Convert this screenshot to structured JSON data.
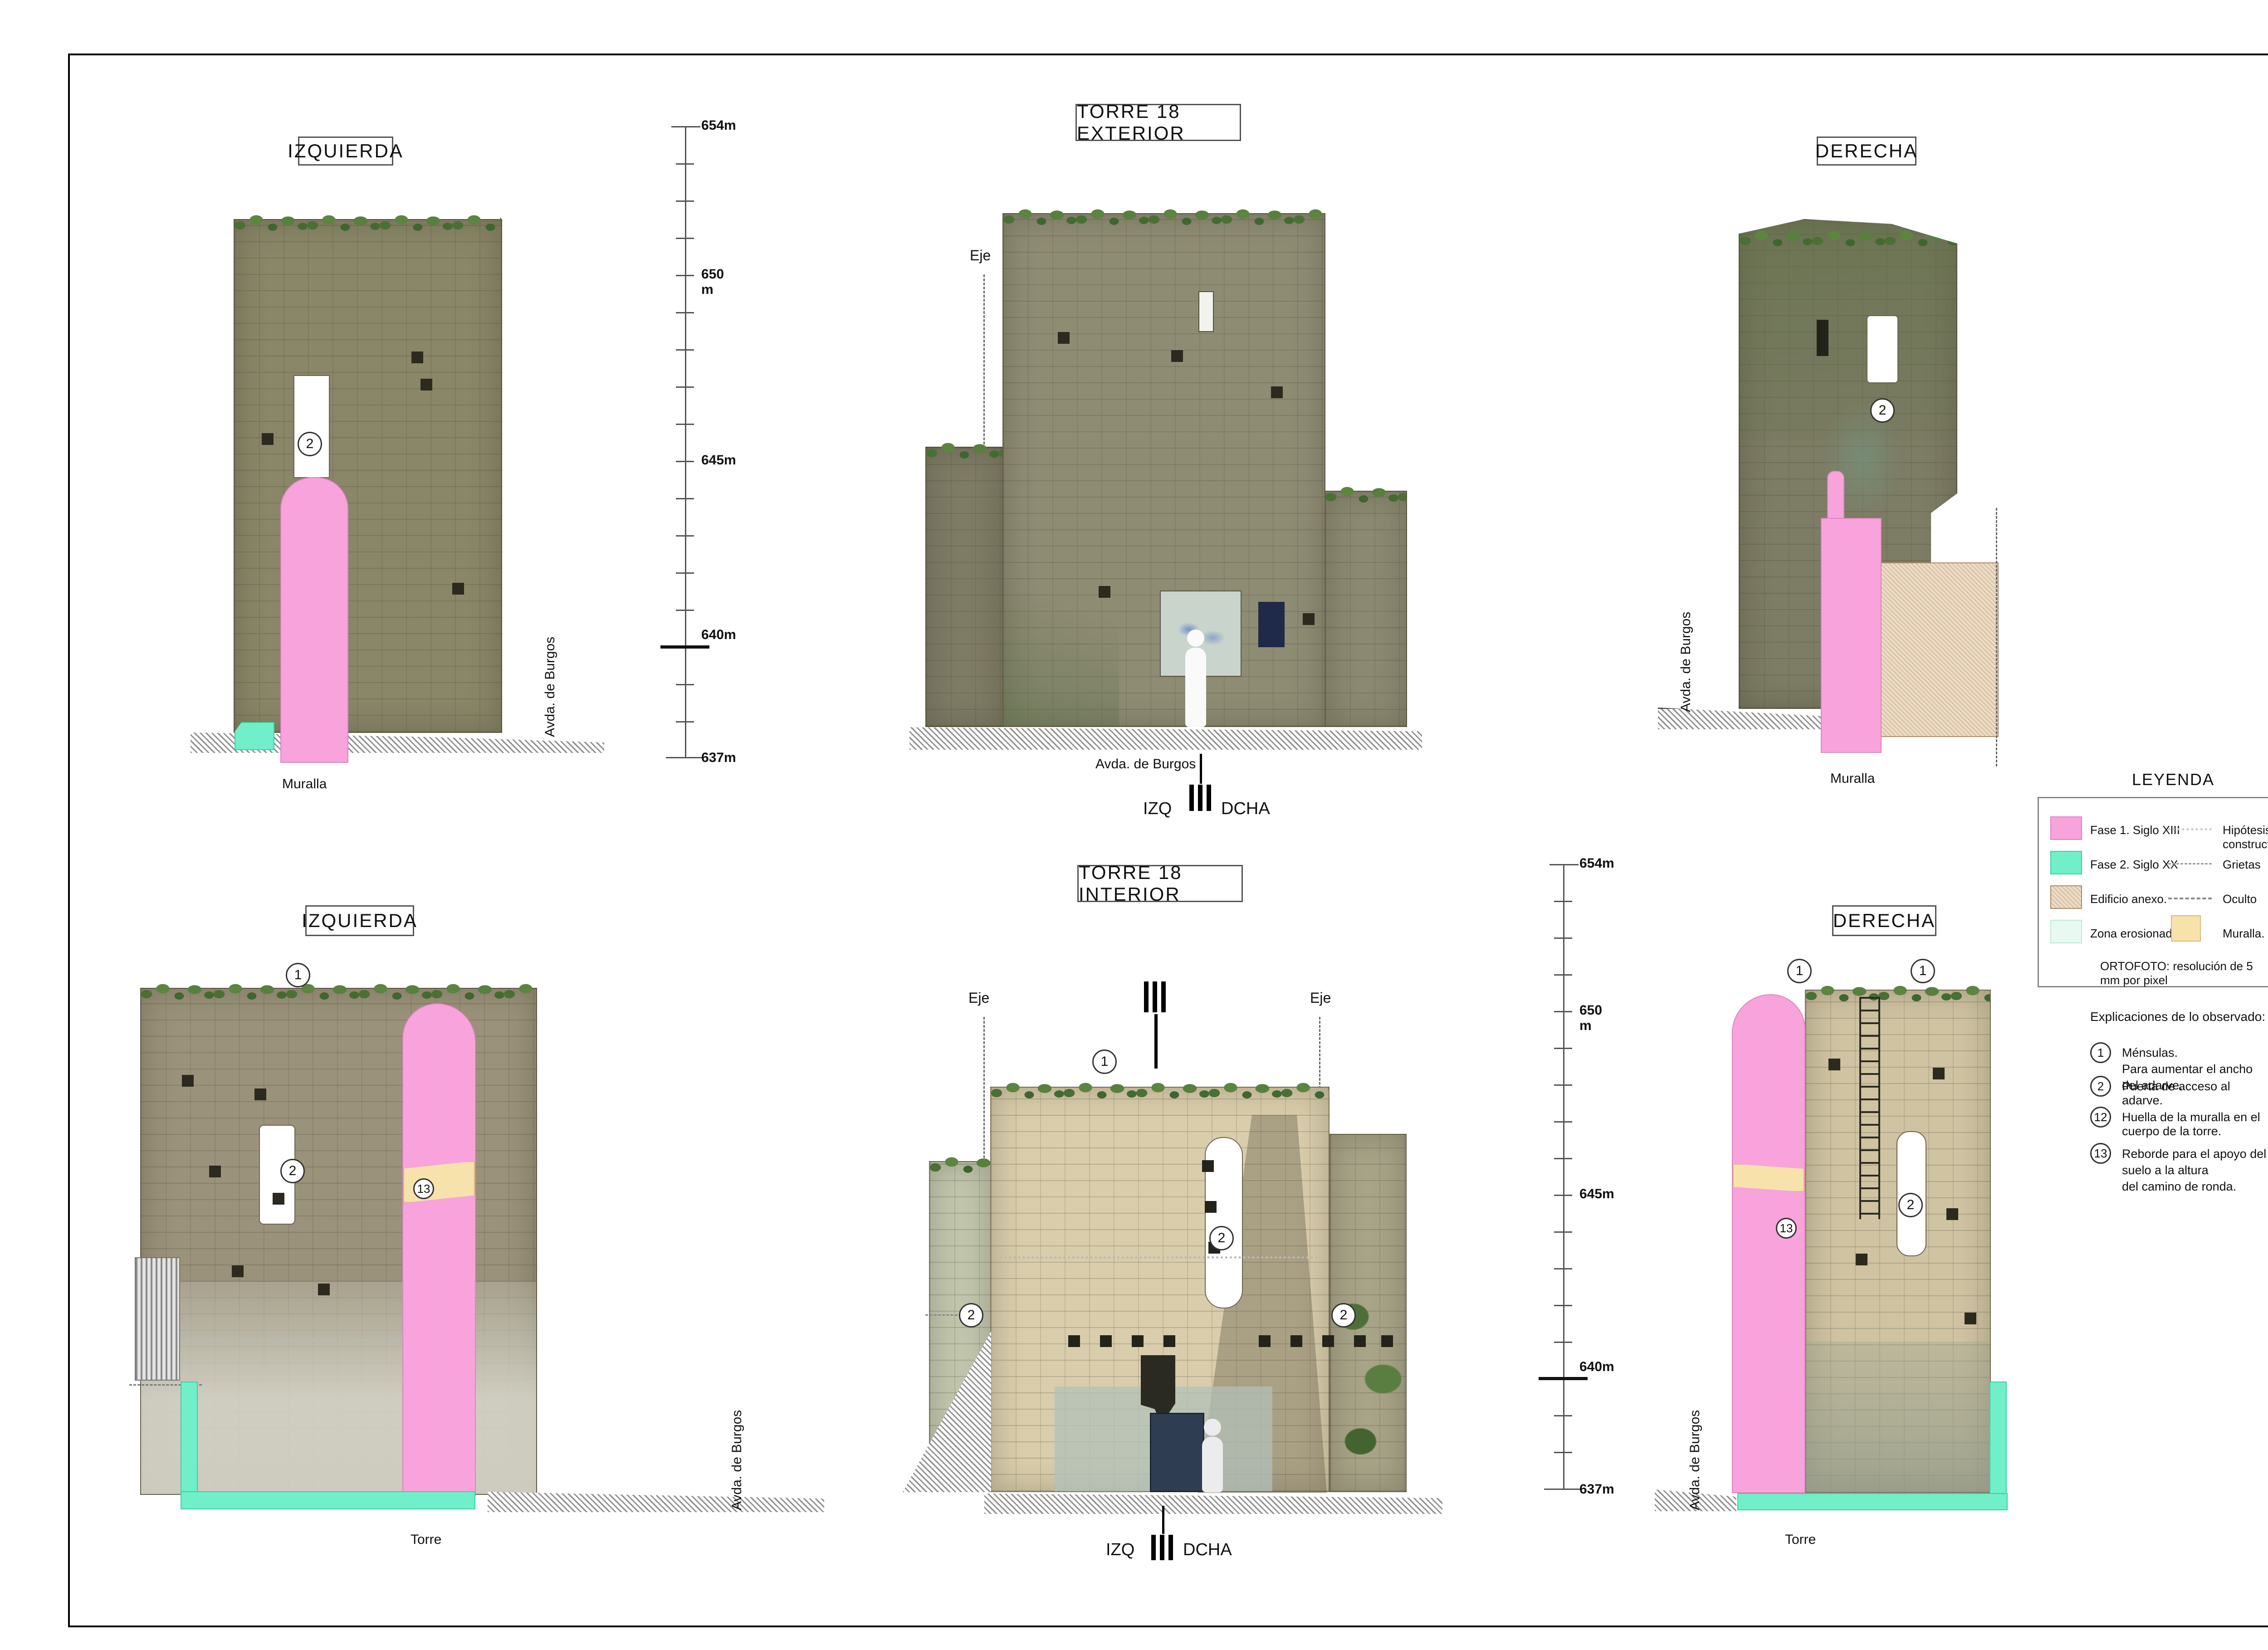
{
  "common": {
    "eje": "Eje",
    "street": "Avda. de Burgos",
    "muralla": "Muralla",
    "torre": "Torre",
    "izq": "IZQ",
    "dcha": "DCHA"
  },
  "views": {
    "top_left": {
      "title": "IZQUIERDA"
    },
    "exterior": {
      "title": "TORRE 18  EXTERIOR"
    },
    "top_right": {
      "title": "DERECHA"
    },
    "bottom_left": {
      "title": "IZQUIERDA"
    },
    "interior": {
      "title": "TORRE 18  INTERIOR"
    },
    "bottom_right": {
      "title": "DERECHA"
    }
  },
  "markers": {
    "n1": "1",
    "n2": "2",
    "n12": "12",
    "n13": "13"
  },
  "elevation": {
    "e654": "654m",
    "e650": "650 m",
    "e645": "645m",
    "e640": "640m",
    "e637": "637m"
  },
  "legend": {
    "title": "LEYENDA",
    "left": [
      {
        "label": "Fase 1.  Siglo XIII"
      },
      {
        "label": "Fase 2.  Siglo XX"
      },
      {
        "label": "Edificio anexo."
      },
      {
        "label": "Zona erosionada."
      }
    ],
    "right": [
      {
        "label": "Hipótesis constructiva"
      },
      {
        "label": "Grietas"
      },
      {
        "label": "Oculto"
      },
      {
        "label": "Muralla."
      }
    ]
  },
  "notes": {
    "ortofoto": "ORTOFOTO: resolución de 5 mm por pixel",
    "title": "Explicaciones de lo observado:",
    "items": [
      {
        "num": "1",
        "line1": "Ménsulas.",
        "line2": "Para aumentar el ancho del adarve."
      },
      {
        "num": "2",
        "line1": "Puerta de acceso al adarve.",
        "line2": ""
      },
      {
        "num": "12",
        "line1": "Huella de la muralla en el cuerpo de la torre.",
        "line2": ""
      },
      {
        "num": "13",
        "line1": "Reborde para el apoyo del suelo a la altura",
        "line2": "del camino de ronda."
      }
    ]
  },
  "map": {
    "dcha_top": "DCHA",
    "izq_mid": "IZQ",
    "dcha_mid": "DCHA",
    "izq_bot": "IZQ",
    "alz_ext": "ALZ. EXT.",
    "alz_int": "ALZ. INT.",
    "torre_box": "TORRE  18",
    "north": "N"
  },
  "graphic_scale": {
    "title": "ESCALA GRÁFICA   1 / 75",
    "t0": "0m",
    "t1": "1",
    "t2": "2",
    "t3": "3",
    "t4": "4",
    "t5": "5m",
    "t10": "10m"
  },
  "title_block": {
    "logo_a": "A",
    "logo_mr": "MR",
    "firm1": "LEVANTAMIENTOS",
    "firm2": "ARQUITECTÓNICOS",
    "firm3": "Y ARQUEOLÓGICOS",
    "phone": "Tf: + 34  609 53 51 79",
    "email": "amr @levantamientos.com",
    "project1": "LEVANTAMIENTO ARQUITECTÓNICO",
    "project2": "MURALLAS DE SANTO DOMINGO DE LA CALZADA",
    "region": "LA  RIOJA",
    "tramo": "TRAMO AVDA. DE BURGOS",
    "date": "MARZO  2022",
    "plano_label": "PLANO:",
    "plano": "TORRE  18",
    "num_label": "Nº:",
    "num": "3.2",
    "escala_label": "ESCALA",
    "escala": "1:75",
    "client1": "Gobierno de la Rioja",
    "client2": "Dirección General de Cultura"
  },
  "website": "www.levantamientos.com"
}
